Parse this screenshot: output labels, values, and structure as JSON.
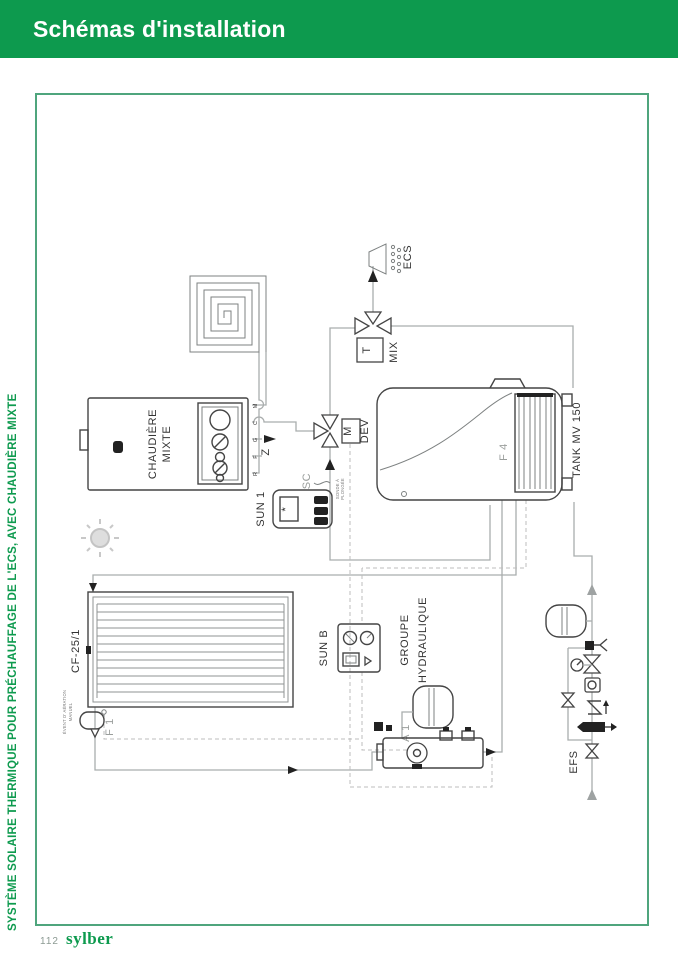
{
  "header": {
    "title": "Schémas d'installation",
    "bg_color": "#0d9a4e",
    "text_color": "#ffffff"
  },
  "side": {
    "label": "SYSTÈME SOLAIRE THERMIQUE POUR PRÉCHAUFFAGE DE L'ECS, AVEC CHAUDIÈRE MIXTE"
  },
  "footer": {
    "page": "112",
    "brand": "sylber"
  },
  "colors": {
    "accent_green": "#0d9a4e",
    "frame_green": "#4fa57d",
    "pipe_gray": "#a9adad",
    "equipment_dark": "#444444"
  },
  "diagram": {
    "ecs": "ECS",
    "mix": "MIX",
    "mix_t": "T",
    "dev": "DEV",
    "dev_m": "M",
    "gas_z": "Z",
    "boiler_line1": "CHAUDIÈRE",
    "boiler_line2": "MIXTE",
    "ports": [
      "M",
      "C",
      "G",
      "F",
      "R"
    ],
    "sun1": "SUN 1",
    "sun1_display": "*",
    "sc": "SC",
    "sc_note1": "SONDE À",
    "sc_note2": "PLONGÉE",
    "tank": "TANK MV 150",
    "f4": "F 4",
    "collector": "CF-25/1",
    "f1": "F 1",
    "vent_note1": "ÉVENT D' AÉRATION",
    "vent_note2": "MANUEL",
    "sunb": "SUN B",
    "group1": "GROUPE",
    "group2": "HYDRAULIQUE",
    "a1": "A 1",
    "efs": "EFS"
  }
}
